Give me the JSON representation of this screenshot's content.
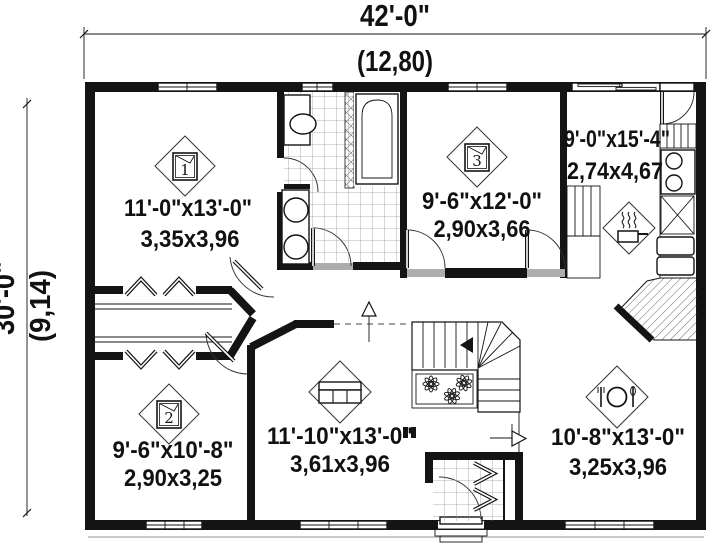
{
  "dimensions": {
    "top": {
      "imperial": "42'-0\"",
      "metric": "(12,80)"
    },
    "left": {
      "imperial": "30'-0\"",
      "metric": "(9,14)"
    }
  },
  "rooms": {
    "bedroom1": {
      "imperial": "11'-0\"x13'-0\"",
      "metric": "3,35x3,96",
      "number": "1"
    },
    "bedroom2": {
      "imperial": "9'-6\"x10'-8\"",
      "metric": "2,90x3,25",
      "number": "2"
    },
    "bedroom3": {
      "imperial": "9'-6\"x12'-0\"",
      "metric": "2,90x3,66",
      "number": "3"
    },
    "kitchen": {
      "imperial": "9'-0\"x15'-4\"",
      "metric": "2,74x4,67"
    },
    "living": {
      "imperial": "11'-10\"x13'-0\"",
      "metric": "3,61x3,96"
    },
    "dining": {
      "imperial": "10'-8\"x13'-0\"",
      "metric": "3,25x3,96"
    }
  },
  "colors": {
    "line": "#141414",
    "background": "#ffffff",
    "sill": "#adadad"
  }
}
